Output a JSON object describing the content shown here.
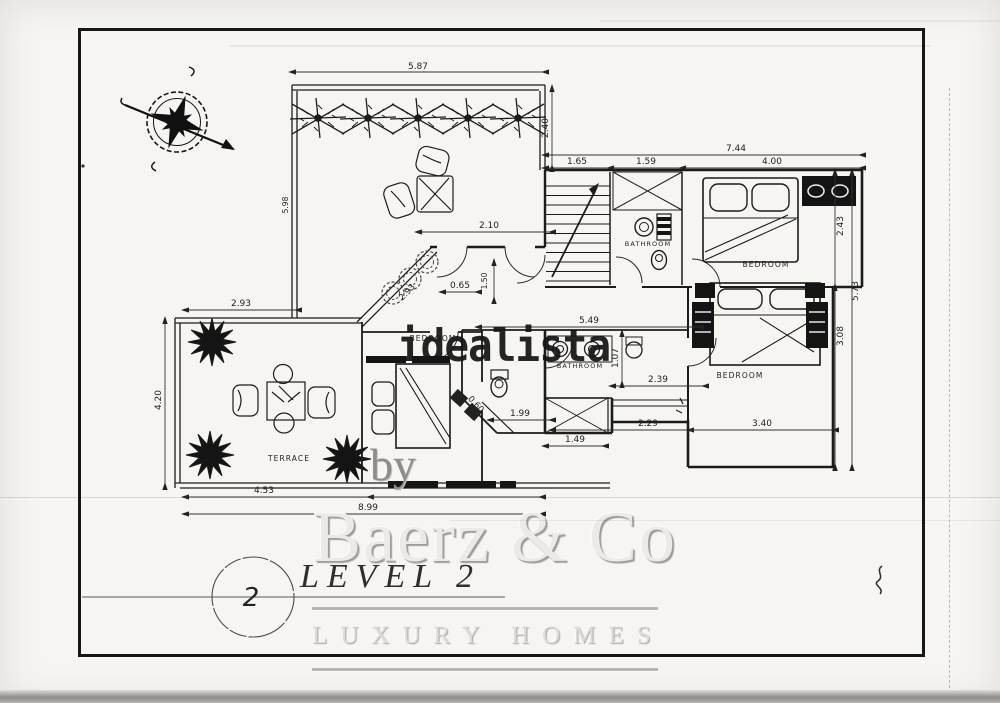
{
  "sheet": {
    "number_in_circle": "2",
    "level_title": "LEVEL 2"
  },
  "watermarks": {
    "listing_site": "idealista",
    "by_text": "by",
    "brand_name": "Baerz & Co",
    "brand_tagline": "LUXURY HOMES"
  },
  "plan": {
    "room_labels": [
      "BATHROOM",
      "BEDROOM",
      "BATHROOM",
      "BEDROOM",
      "BEDROOM",
      "TERRACE"
    ],
    "dimensions": [
      "5.87",
      "2.40",
      "7.44",
      "1.65",
      "1.59",
      "4.00",
      "2.43",
      "5.73",
      "3.08",
      "2.10",
      "0.65",
      "1.50",
      "5.98",
      "2.93",
      "2.93",
      "4.20",
      "5.49",
      "1.07",
      "2.39",
      "1.99",
      "2.29",
      "3.40",
      "1.49",
      "0.60",
      "4.53",
      "8.99"
    ]
  },
  "colors": {
    "ink": "#1c1c1c",
    "paper": "#f6f5f2",
    "watermark_light": "#e7e5e1",
    "watermark_mid": "#b7b5b1"
  }
}
